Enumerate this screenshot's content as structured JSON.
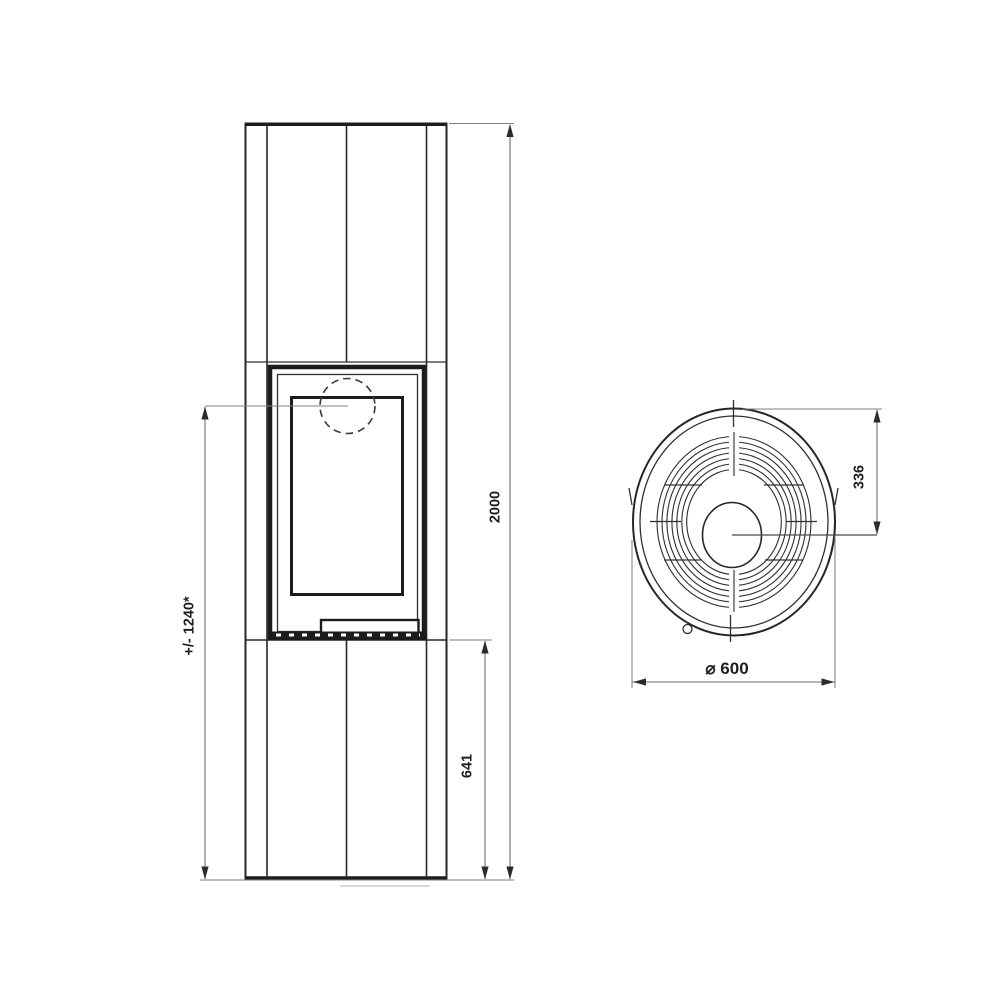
{
  "drawing": {
    "views": {
      "front_view": "stove-front-elevation",
      "top_view": "stove-top-plan"
    },
    "dimensions": {
      "overall_height": "2000",
      "door_top_height": "+/- 1240*",
      "lower_section_height": "641",
      "flue_center_offset": "336",
      "diameter": "⌀ 600"
    },
    "colors": {
      "background": "#ffffff",
      "object_line": "#262626",
      "dimension_line": "#6e6e6e",
      "text": "#1f1f1f"
    }
  }
}
